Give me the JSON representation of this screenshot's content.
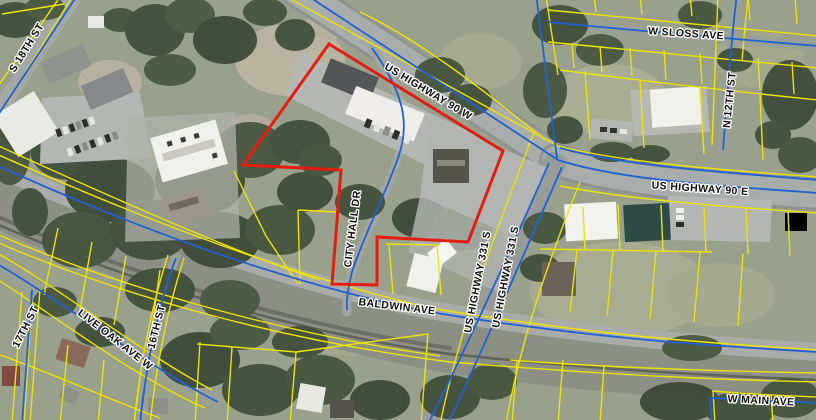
{
  "map": {
    "labels": {
      "s_18th_st": "S 18TH ST",
      "us_highway_90_w": "US HIGHWAY 90 W",
      "w_sloss_ave": "W SLOSS AVE",
      "n_12th_st": "N 12TH ST",
      "us_highway_90_e": "US HIGHWAY 90 E",
      "city_hall_dr": "CITY HALL DR",
      "us_highway_331_s_1": "US HIGHWAY 331 S",
      "us_highway_331_s_2": "US HIGHWAY 331 S",
      "baldwin_ave": "BALDWIN AVE",
      "live_oak_ave_w": "LIVE OAK AVE W",
      "sixteenth_st": "16TH ST",
      "seventeenth_st": "17TH ST",
      "w_main_ave": "W MAIN AVE"
    },
    "colors": {
      "parcel_line": "#ece308",
      "road_line": "#2161d1",
      "selection": "#e21d11",
      "label_text": "#0e0e0e",
      "label_halo": "#ffffff"
    }
  }
}
